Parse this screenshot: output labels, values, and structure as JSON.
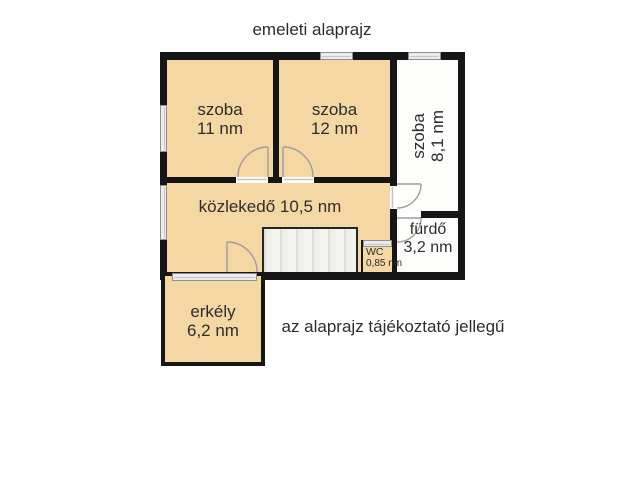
{
  "title": "emeleti alaprajz",
  "note": "az alaprajz tájékoztató jellegű",
  "rooms": {
    "szoba11": {
      "name": "szoba",
      "area": "11 nm"
    },
    "szoba12": {
      "name": "szoba",
      "area": "12 nm"
    },
    "szoba81": {
      "name": "szoba",
      "area": "8,1 nm"
    },
    "kozlekedo": {
      "name": "közlekedő",
      "area": "10,5 nm"
    },
    "furdo": {
      "name": "fürdő",
      "area": "3,2 nm"
    },
    "wc": {
      "name": "WC",
      "area": "0,85 nm"
    },
    "erkely": {
      "name": "erkély",
      "area": "6,2 nm"
    }
  },
  "colors": {
    "room_fill": "#f4d7a3",
    "wall": "#161616",
    "white_room": "#fdfdfb",
    "stairs_fill": "#f3f3f0",
    "window_fill": "#ececea",
    "window_border": "#8f8f8f",
    "door_stroke": "#9e9e9e",
    "text": "#2d2d2d",
    "background": "#ffffff"
  }
}
